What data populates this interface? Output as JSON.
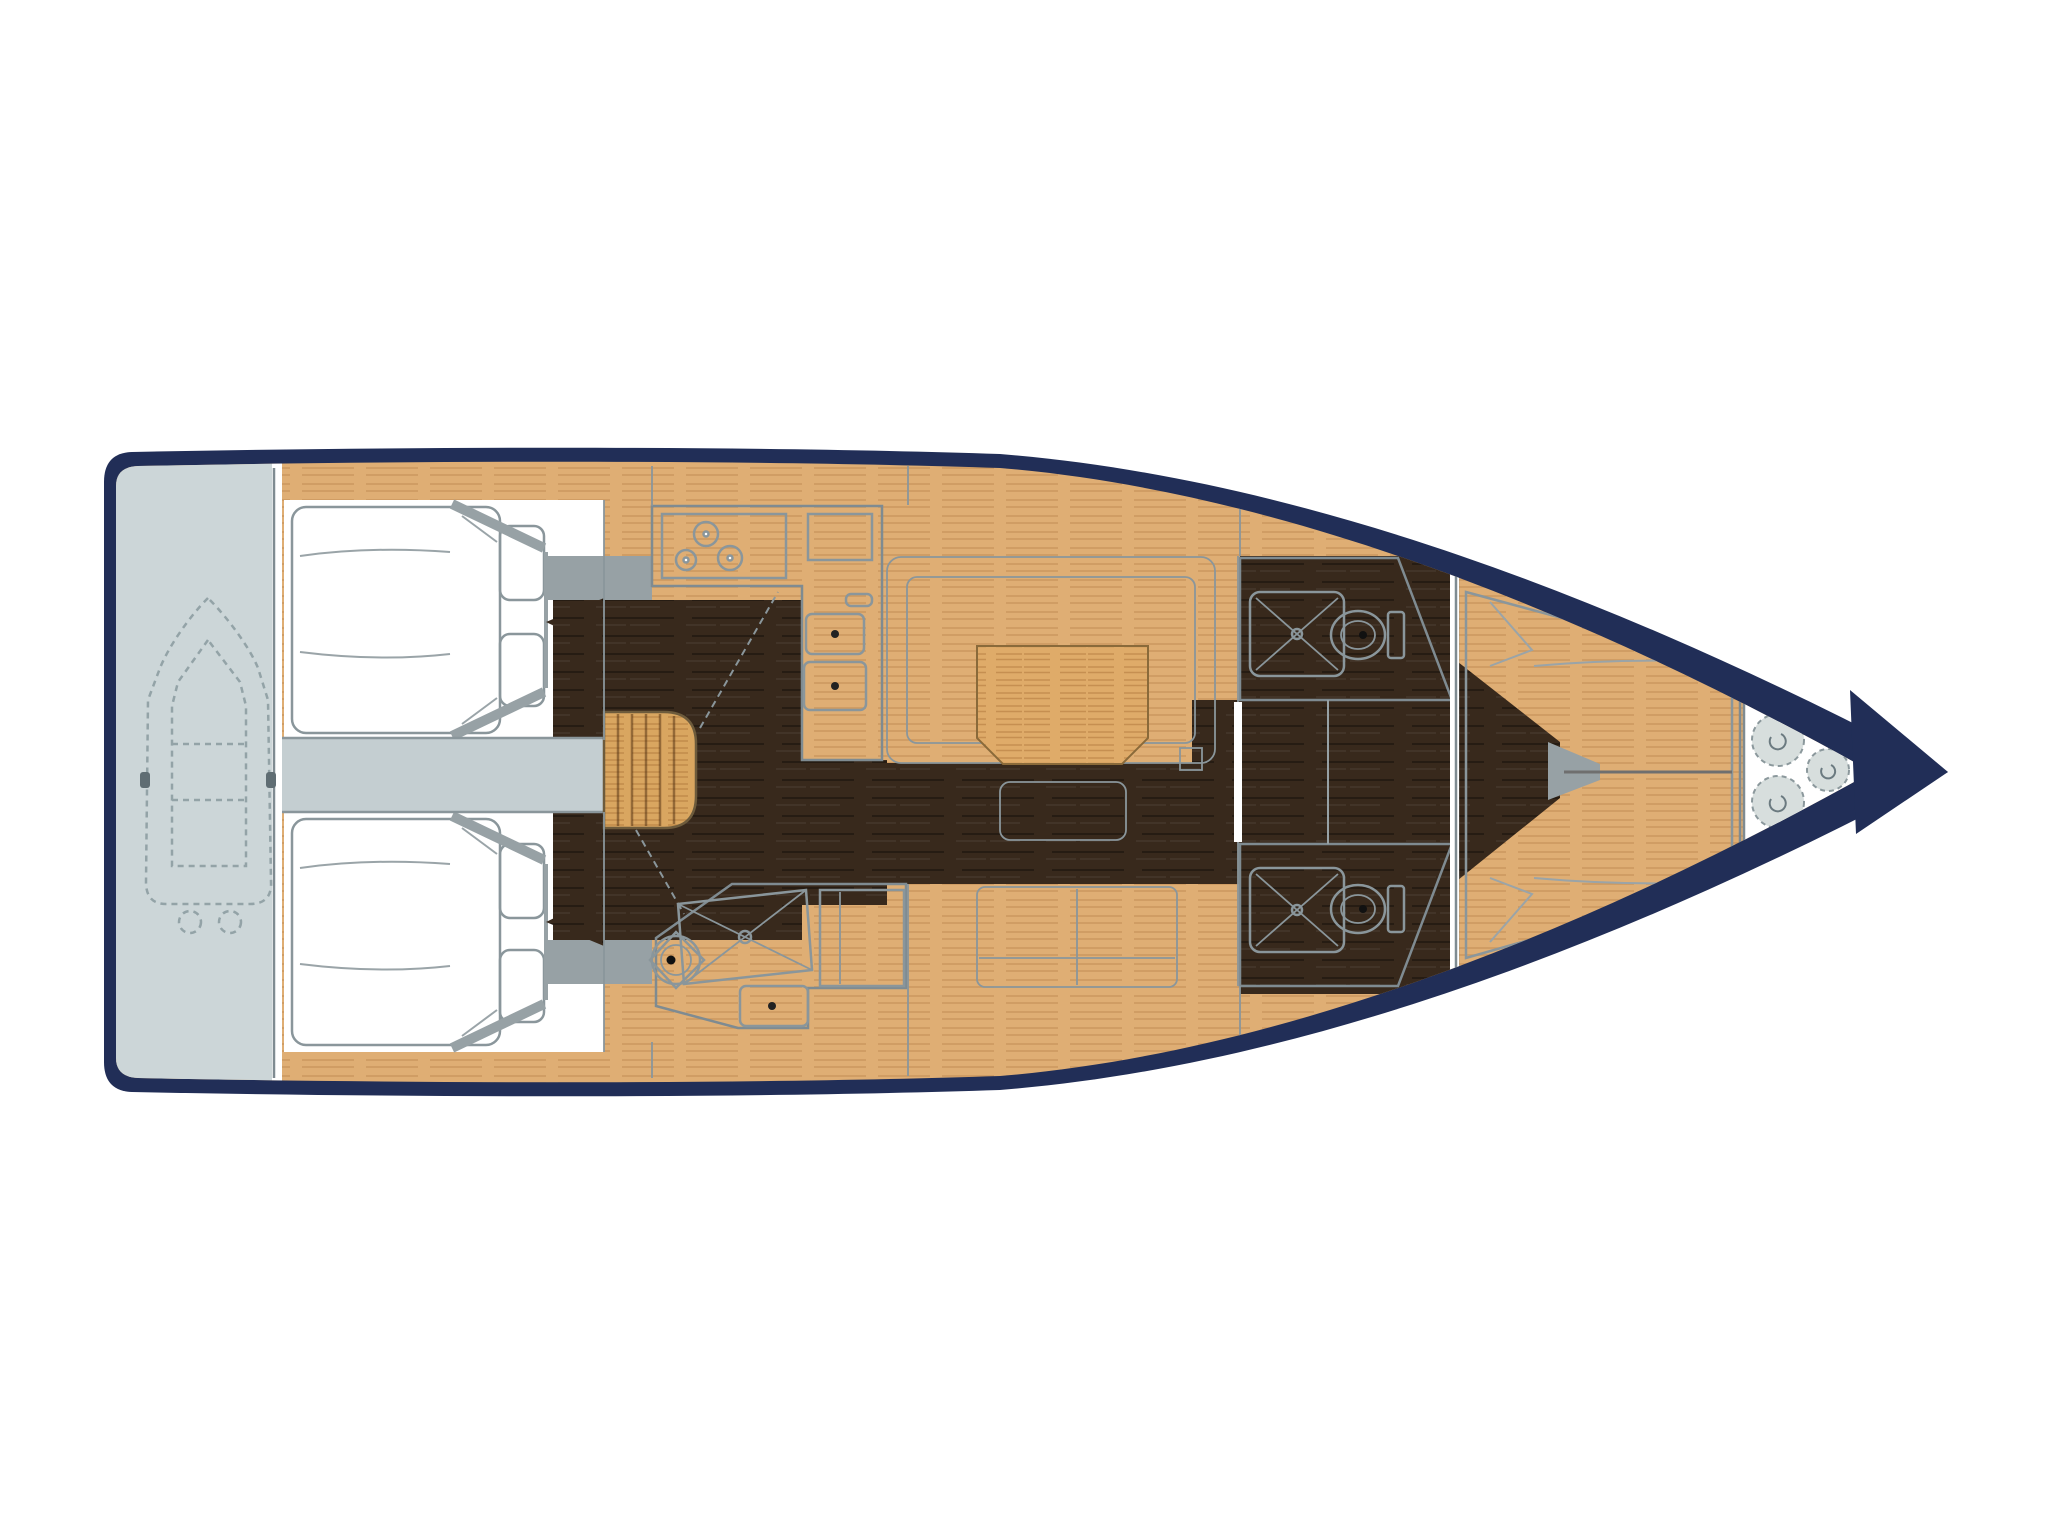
{
  "diagram": {
    "type": "floor-plan",
    "subject": "sailing-yacht-interior-layout",
    "title": "Sailing yacht interior layout floor plan, bow pointing right",
    "orientation": {
      "bow": "right",
      "stern": "left"
    },
    "canvas": {
      "width": 2048,
      "height": 1534
    }
  },
  "palette": {
    "background": "#ffffff",
    "hull_navy": "#212e57",
    "deck_oak": "#dfae74",
    "steps_oak": "#d9a660",
    "table_oak": "#dfab69",
    "floor_dark": "#38291c",
    "upholstery_gray": "#a9afad",
    "platform_gray": "#ccd6d8",
    "passage_gray": "#c4ced1",
    "wall_gray": "#97a1a5",
    "room_white": "#ffffff",
    "outline_gray": "#7f8b91",
    "fixture_gray": "#8a969b",
    "fender_gray": "#d7dedd",
    "dinghy_line": "#93a3a7"
  },
  "regions": [
    {
      "id": "bathing-platform",
      "label": "Stern bathing platform"
    },
    {
      "id": "dinghy",
      "label": "Dinghy stowed on platform"
    },
    {
      "id": "aft-cabin-top",
      "label": "Aft double cabin (starboard)"
    },
    {
      "id": "aft-cabin-bottom",
      "label": "Aft double cabin (port)"
    },
    {
      "id": "cockpit-passage",
      "label": "Cockpit passage"
    },
    {
      "id": "companionway-steps",
      "label": "Companionway steps"
    },
    {
      "id": "galley",
      "label": "L-shaped galley"
    },
    {
      "id": "aft-head",
      "label": "Aft bathroom with shower"
    },
    {
      "id": "salon-settee",
      "label": "U-shaped salon settee"
    },
    {
      "id": "salon-table",
      "label": "Salon table"
    },
    {
      "id": "salon-ottoman",
      "label": "Salon ottoman"
    },
    {
      "id": "salon-bench",
      "label": "Salon side bench"
    },
    {
      "id": "fwd-head-top",
      "label": "Forward bathroom (starboard)"
    },
    {
      "id": "fwd-head-bottom",
      "label": "Forward bathroom (port)"
    },
    {
      "id": "corridor",
      "label": "Corridor to forward cabin"
    },
    {
      "id": "forward-cabin",
      "label": "Forward V-berth cabin"
    },
    {
      "id": "sail-locker",
      "label": "Bow locker with fenders"
    }
  ],
  "fixtures": {
    "stove_burners": 3,
    "galley_sinks": 2,
    "toilets": 3,
    "shower_trays": 3,
    "bow_fenders": 3,
    "cabins": 3,
    "berth_pillows": 4
  }
}
